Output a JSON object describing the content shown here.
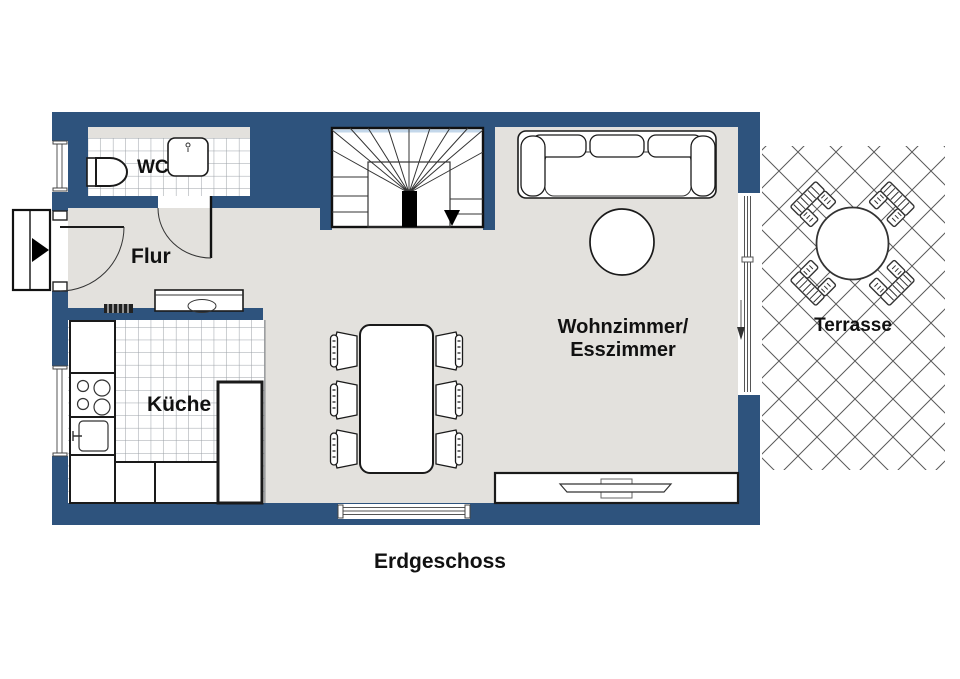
{
  "plan": {
    "floor_label": "Erdgeschoss",
    "rooms": [
      {
        "id": "wc",
        "label": "WC"
      },
      {
        "id": "flur",
        "label": "Flur"
      },
      {
        "id": "kueche",
        "label": "Küche"
      },
      {
        "id": "wohnzimmer-esszimmer",
        "label_line1": "Wohnzimmer/",
        "label_line2": "Esszimmer"
      },
      {
        "id": "terrasse",
        "label": "Terrasse"
      }
    ],
    "colors": {
      "wall_blue": "#2e537d",
      "floor_gray": "#e3e1dd",
      "tile_line": "#9aa0a6",
      "glass_light_blue": "#c3d7ea",
      "outline_black": "#1a1a1a"
    }
  }
}
